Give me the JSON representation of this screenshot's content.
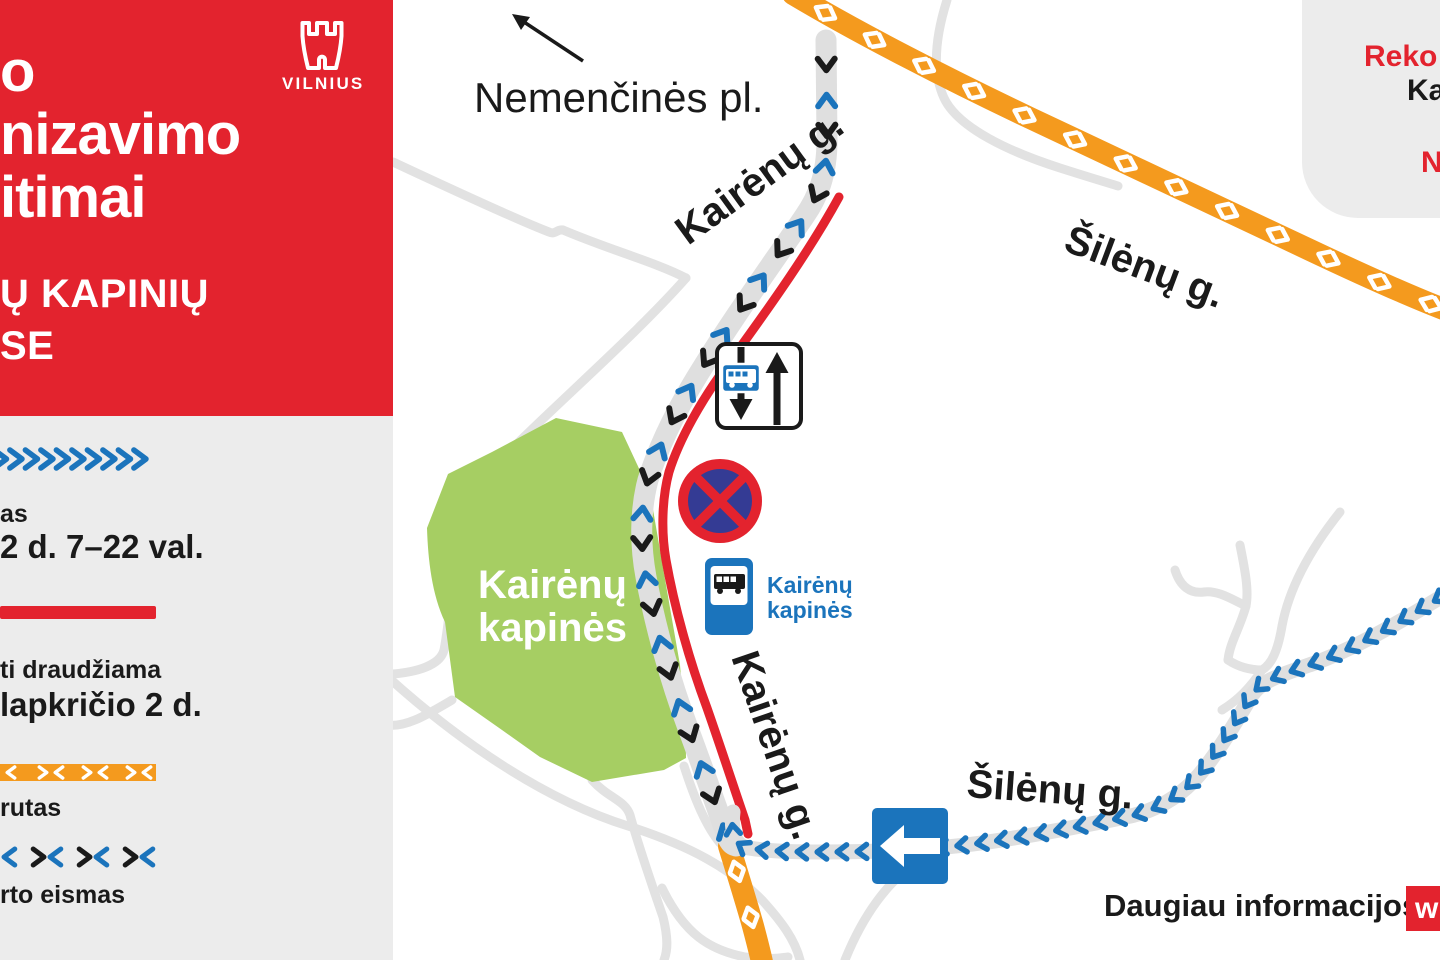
{
  "colors": {
    "brand-red": "#E3232E",
    "orange": "#F49A1E",
    "blue": "#1B74BC",
    "sign-navy": "#343B94",
    "green": "#A6CE63",
    "ink": "#1A1A1A",
    "road-gray": "#E2E2E2",
    "band-gray": "#DFDFDF",
    "panel-gray": "#ECECEC"
  },
  "panel": {
    "title_lines": [
      "o",
      "nizavimo",
      "itimai"
    ],
    "subtitle_lines": [
      "Ų KAPINIŲ",
      "SE"
    ],
    "logo_text": "VILNIUS"
  },
  "legend": {
    "items": [
      {
        "id": "one-way-direction",
        "sub": "as",
        "main": "2 d. 7–22 val."
      },
      {
        "id": "no-stopping-zone",
        "sub": "ti draudžiama",
        "main": "lapkričio 2 d."
      },
      {
        "id": "detour-route",
        "sub": "rutas",
        "main": ""
      },
      {
        "id": "public-transport",
        "sub": "rto eismas",
        "main": ""
      }
    ]
  },
  "map": {
    "labels": {
      "nemencines": "Nemenčinės pl.",
      "kairenu_top": "Kairėnų g.",
      "kairenu_bottom": "Kairėnų g.",
      "silenu_top": "Šilėnų g.",
      "silenu_bottom": "Šilėnų g.",
      "cemetery": [
        "Kairėnų",
        "kapinės"
      ],
      "bus_stop": [
        "Kairėnų",
        "kapinės"
      ]
    }
  },
  "info_card": {
    "lines": [
      {
        "text": "Reko",
        "color": "red"
      },
      {
        "text": "Ka",
        "color": "ink"
      },
      {
        "text": "N",
        "color": "red"
      }
    ]
  },
  "footer": {
    "text": "Daugiau informacijos",
    "badge": "w"
  }
}
